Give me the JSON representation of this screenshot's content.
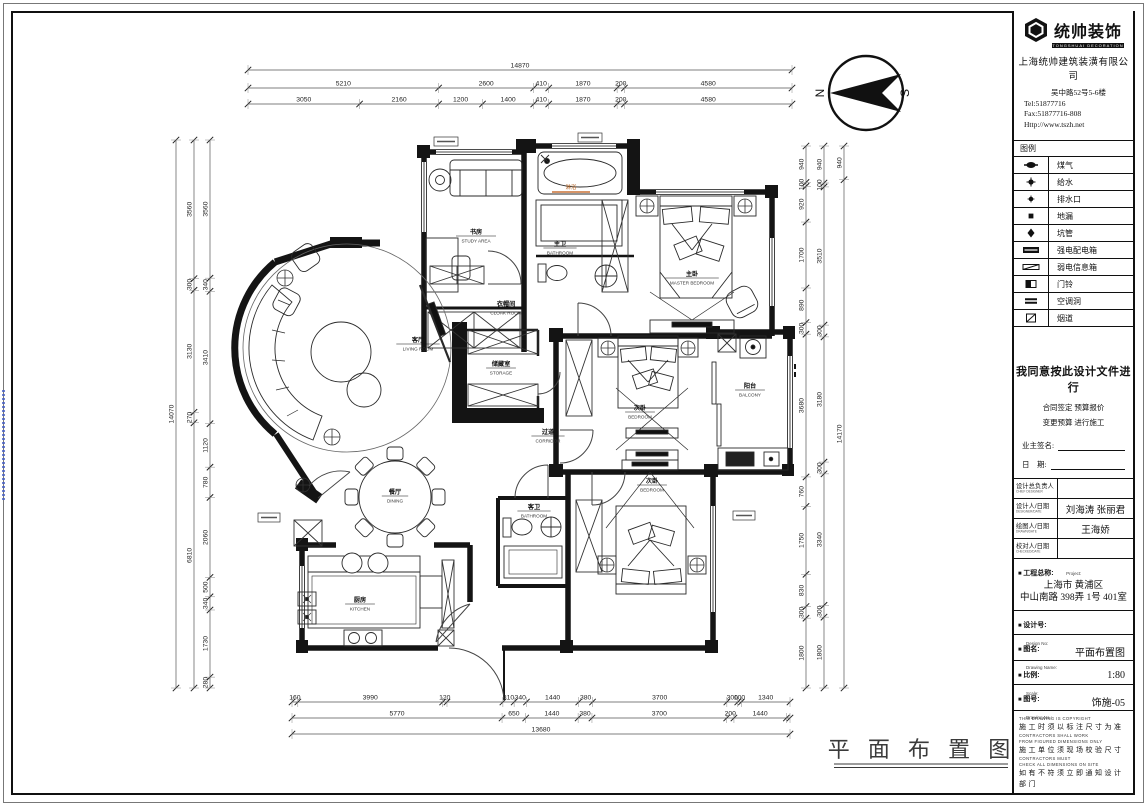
{
  "frame": {
    "right_watermark": "Autodesk"
  },
  "brand": {
    "logo_text": "统帅装饰",
    "logo_sub": "TONGSHUAI DECORATION",
    "company": "上海统帅建筑装潢有限公司",
    "address": "吴中路52号5-6楼",
    "tel": "Tel:51877716",
    "fax": "Fax:51877716-808",
    "web": "Http://www.tszh.net"
  },
  "legend": {
    "title": "图例",
    "items": [
      {
        "icon": "gas-meter",
        "label": "煤气"
      },
      {
        "icon": "water-supply",
        "label": "给水"
      },
      {
        "icon": "drain-outlet",
        "label": "排水口"
      },
      {
        "icon": "floor-drain",
        "label": "地漏"
      },
      {
        "icon": "pit-pipe",
        "label": "坑管"
      },
      {
        "icon": "power-distribution-box",
        "label": "强电配电箱"
      },
      {
        "icon": "low-voltage-box",
        "label": "弱电信息箱"
      },
      {
        "icon": "doorbell",
        "label": "门铃"
      },
      {
        "icon": "ac-hole",
        "label": "空调洞"
      },
      {
        "icon": "flue",
        "label": "烟道"
      }
    ]
  },
  "agreement": {
    "main": "我同意按此设计文件进行",
    "line2": "合同签定  预算报价",
    "line3": "变更预算  进行施工",
    "sign_label": "业主签名:",
    "date_label": "日　期:"
  },
  "personnel": {
    "rows": [
      {
        "label": "设计总负责人",
        "sub": "CHIEF DESIGNER",
        "value": ""
      },
      {
        "label": "设计人/日期",
        "sub": "DESIGNER/DATE",
        "value": "刘海涛 张丽君"
      },
      {
        "label": "绘图人/日期",
        "sub": "DRAWN/DATE",
        "value": "王海娇"
      },
      {
        "label": "校对人/日期",
        "sub": "CHECKED/DATE",
        "value": ""
      }
    ]
  },
  "project": {
    "label": "工程总称:",
    "sub": "Project:",
    "value_line1": "上海市 黄浦区",
    "value_line2": "中山南路 398弄 1号 401室"
  },
  "design_no": {
    "label": "设计号:",
    "sub": "Design No:",
    "value": ""
  },
  "drawing_name": {
    "label": "图名:",
    "sub": "Drawing Name:",
    "value": "平面布置图"
  },
  "scale": {
    "label": "比例:",
    "sub": "Scale:",
    "value": "1:80"
  },
  "drawing_no": {
    "label": "图号:",
    "sub": "Drawing No.:",
    "value": "饰施-05"
  },
  "notes": {
    "lines": [
      {
        "t": "THIS DRAWING IS COPYRIGHT",
        "lang": "en"
      },
      {
        "t": "施工时须以标注尺寸为准",
        "lang": "zh"
      },
      {
        "t": "CONTRACTORS SHALL WORK",
        "lang": "en"
      },
      {
        "t": "FROM FIGURED DIMENSIONS ONLY",
        "lang": "en"
      },
      {
        "t": "施工单位须现场校验尺寸",
        "lang": "zh"
      },
      {
        "t": "CONTRACTORS MUST",
        "lang": "en"
      },
      {
        "t": "CHECK ALL DIMENSIONS ON SITE",
        "lang": "en"
      },
      {
        "t": "如有不符须立即通知设计部门",
        "lang": "zh"
      }
    ]
  },
  "plan": {
    "sheet_title": "平 面 布 置 图",
    "compass": {
      "n": "N",
      "s": "S"
    },
    "shower_tag": {
      "label": "淋浴",
      "x": 571,
      "y": 189,
      "color": "#b06020",
      "line_color": "#c87137"
    },
    "rooms": [
      {
        "zh": "书房",
        "en": "STUDY AREA",
        "x": 476,
        "y": 234
      },
      {
        "zh": "衣帽间",
        "en": "CLOAK ROOM",
        "x": 506,
        "y": 306
      },
      {
        "zh": "储藏室",
        "en": "STORAGE",
        "x": 501,
        "y": 366
      },
      {
        "zh": "主卫",
        "en": "BATHROOM",
        "x": 560,
        "y": 246
      },
      {
        "zh": "主卧",
        "en": "MASTER BEDROOM",
        "x": 692,
        "y": 276
      },
      {
        "zh": "客厅",
        "en": "LIVING ROOM",
        "x": 418,
        "y": 342
      },
      {
        "zh": "过道",
        "en": "CORRIDOR",
        "x": 548,
        "y": 434
      },
      {
        "zh": "次卧",
        "en": "BEDROOM",
        "x": 640,
        "y": 410
      },
      {
        "zh": "阳台",
        "en": "BALCONY",
        "x": 750,
        "y": 388
      },
      {
        "zh": "客卫",
        "en": "BATHROOM",
        "x": 534,
        "y": 509
      },
      {
        "zh": "次卧",
        "en": "BEDROOM",
        "x": 652,
        "y": 483
      },
      {
        "zh": "餐厅",
        "en": "DINING",
        "x": 395,
        "y": 494
      },
      {
        "zh": "厨房",
        "en": "KITCHEN",
        "x": 360,
        "y": 602
      }
    ],
    "dims": [
      {
        "axis": "h",
        "line": 70,
        "from": 248,
        "to": 792,
        "segs": [
          [
            "14870",
            14870
          ]
        ]
      },
      {
        "axis": "h",
        "line": 88,
        "from": 248,
        "to": 792,
        "segs": [
          [
            "5210",
            5210
          ],
          [
            "2600",
            2600
          ],
          [
            "410",
            410
          ],
          [
            "1870",
            1870
          ],
          [
            "200",
            200
          ],
          [
            "4580",
            4580
          ]
        ]
      },
      {
        "axis": "h",
        "line": 104,
        "from": 248,
        "to": 792,
        "segs": [
          [
            "3050",
            3050
          ],
          [
            "2160",
            2160
          ],
          [
            "1200",
            1200
          ],
          [
            "1400",
            1400
          ],
          [
            "410",
            410
          ],
          [
            "1870",
            1870
          ],
          [
            "200",
            200
          ],
          [
            "4580",
            4580
          ]
        ]
      },
      {
        "axis": "v",
        "line": 176,
        "from": 140,
        "to": 688,
        "segs": [
          [
            "14070",
            14070
          ]
        ]
      },
      {
        "axis": "v",
        "line": 194,
        "from": 140,
        "to": 688,
        "segs": [
          [
            "3560",
            3560
          ],
          [
            "300",
            300
          ],
          [
            "3130",
            3130
          ],
          [
            "270",
            270
          ],
          [
            "6810",
            6810
          ]
        ]
      },
      {
        "axis": "v",
        "line": 210,
        "from": 140,
        "to": 688,
        "segs": [
          [
            "3560",
            3560
          ],
          [
            "340",
            340
          ],
          [
            "3410",
            3410
          ],
          [
            "1120",
            1120
          ],
          [
            "780",
            780
          ],
          [
            "2060",
            2060
          ],
          [
            "500",
            500
          ],
          [
            "340",
            340
          ],
          [
            "1730",
            1730
          ],
          [
            "280",
            280
          ]
        ]
      },
      {
        "axis": "v",
        "line": 806,
        "from": 146,
        "to": 688,
        "segs": [
          [
            "940",
            940
          ],
          [
            "100",
            100
          ],
          [
            "920",
            920
          ],
          [
            "1700",
            1700
          ],
          [
            "890",
            890
          ],
          [
            "300",
            300
          ],
          [
            "3680",
            3680
          ],
          [
            "760",
            760
          ],
          [
            "1750",
            1750
          ],
          [
            "830",
            830
          ],
          [
            "300",
            300
          ],
          [
            "1800",
            1800
          ]
        ]
      },
      {
        "axis": "v",
        "line": 824,
        "from": 146,
        "to": 688,
        "segs": [
          [
            "940",
            940
          ],
          [
            "100",
            100
          ],
          [
            "3510",
            3510
          ],
          [
            "300",
            300
          ],
          [
            "3180",
            3180
          ],
          [
            "300",
            300
          ],
          [
            "3340",
            3340
          ],
          [
            "300",
            300
          ],
          [
            "1800",
            1800
          ]
        ]
      },
      {
        "axis": "v",
        "line": 844,
        "from": 146,
        "to": 688,
        "segs": [
          [
            "940",
            940
          ],
          [
            "14170",
            14170
          ]
        ]
      },
      {
        "axis": "h",
        "line": 702,
        "from": 292,
        "to": 790,
        "segs": [
          [
            "160",
            160
          ],
          [
            "3990",
            3990
          ],
          [
            "120",
            120
          ],
          [
            "",
            1540
          ],
          [
            "310",
            310
          ],
          [
            "340",
            340
          ],
          [
            "1440",
            1440
          ],
          [
            "380",
            380
          ],
          [
            "3700",
            3700
          ],
          [
            "300",
            300
          ],
          [
            "100",
            100
          ],
          [
            "1340",
            1340
          ]
        ]
      },
      {
        "axis": "h",
        "line": 718,
        "from": 292,
        "to": 790,
        "segs": [
          [
            "5770",
            5770
          ],
          [
            "650",
            650
          ],
          [
            "1440",
            1440
          ],
          [
            "380",
            380
          ],
          [
            "3700",
            3700
          ],
          [
            "200",
            200
          ],
          [
            "1440",
            1440
          ],
          [
            "",
            100
          ]
        ]
      },
      {
        "axis": "h",
        "line": 734,
        "from": 292,
        "to": 790,
        "segs": [
          [
            "13680",
            13680
          ]
        ]
      }
    ]
  }
}
